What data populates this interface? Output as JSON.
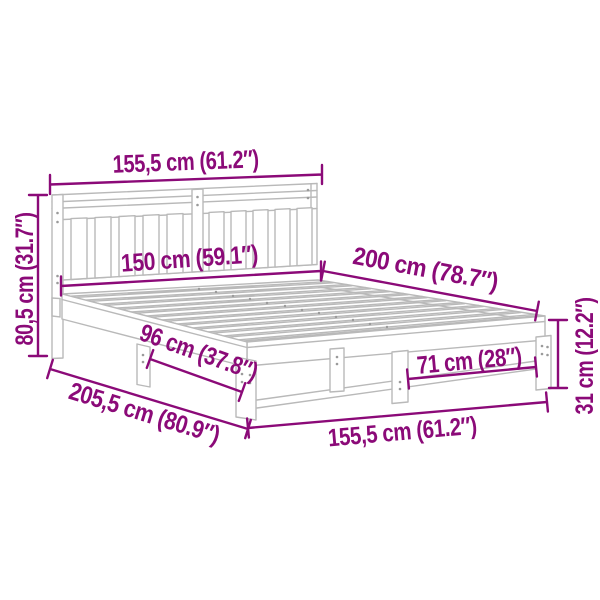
{
  "image": {
    "title": "Bed frame dimension diagram",
    "background": "#ffffff",
    "drawing_color": "#b9b9b9",
    "dimension_color": "#8b0a78"
  },
  "dimensions": [
    {
      "id": "headboard-width-top",
      "label": "155,5 cm (61.2″)"
    },
    {
      "id": "headboard-height",
      "label": "80,5 cm (31.7″)"
    },
    {
      "id": "mattress-width",
      "label": "150 cm (59.1″)"
    },
    {
      "id": "mattress-length",
      "label": "200 cm (78.7″)"
    },
    {
      "id": "side-rail-span",
      "label": "96 cm (37.8″)"
    },
    {
      "id": "total-length",
      "label": "205,5 cm (80.9″)"
    },
    {
      "id": "frame-width-bottom",
      "label": "155,5 cm (61.2″)"
    },
    {
      "id": "foot-leg-span",
      "label": "71 cm (28″)"
    },
    {
      "id": "leg-height",
      "label": "31 cm (12.2″)"
    }
  ]
}
